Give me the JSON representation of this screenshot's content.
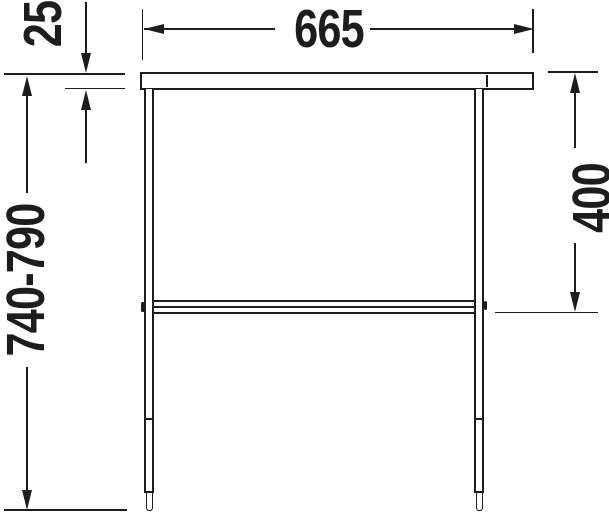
{
  "diagram": {
    "colors": {
      "line": "#1d1d1b",
      "background": "#ffffff"
    },
    "dimensions": {
      "overall_width": "665",
      "top_thickness": "25",
      "overall_height": "740-790",
      "rail_height": "400"
    }
  }
}
